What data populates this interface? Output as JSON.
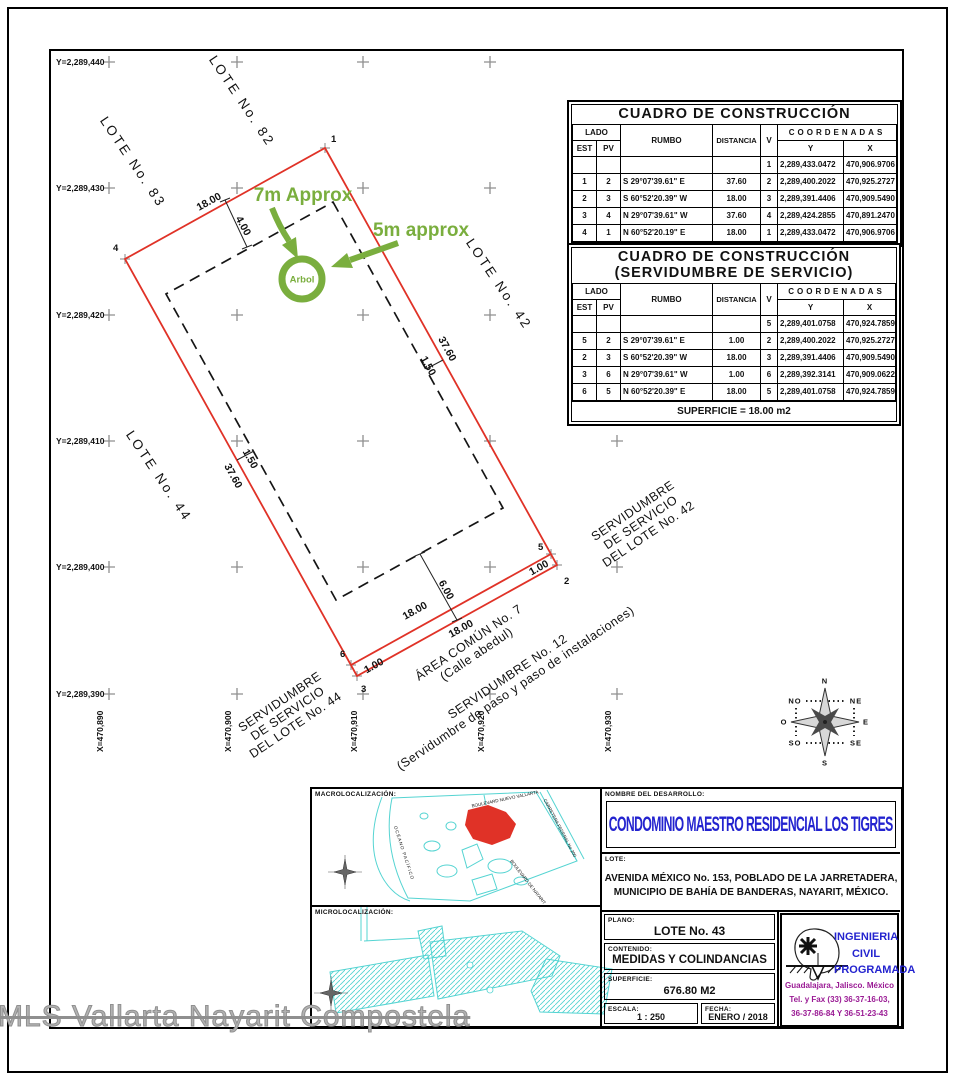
{
  "colors": {
    "boundary_red": "#e03227",
    "annotation_green": "#7aae3e",
    "title_blue": "#2323cf",
    "contact_purple": "#9a1a94",
    "map_cyan": "#55d4d2",
    "grid_gray": "#8f8f8f"
  },
  "plan": {
    "grid": {
      "y_labels": [
        "Y=2,289,440",
        "Y=2,289,430",
        "Y=2,289,420",
        "Y=2,289,410",
        "Y=2,289,400",
        "Y=2,289,390"
      ],
      "x_labels": [
        "X=470,890",
        "X=470,900",
        "X=470,910",
        "X=470,920",
        "X=470,930"
      ]
    },
    "vertices": [
      "1",
      "2",
      "3",
      "4",
      "5",
      "6"
    ],
    "neighbor_lots": {
      "l82": "LOTE No. 82",
      "l83": "LOTE No. 83",
      "l42": "LOTE No. 42",
      "l44": "LOTE No. 44"
    },
    "easements": {
      "serv42": [
        "SERVIDUMBRE",
        "DE SERVICIO",
        "DEL LOTE No. 42"
      ],
      "serv44": [
        "SERVIDUMBRE",
        "DE SERVICIO",
        "DEL LOTE No. 44"
      ],
      "area": [
        "ÁREA COMÚN No. 7",
        "(Calle abedul)"
      ],
      "serv12": [
        "SERVIDUMBRE No. 12",
        "(Servidumbre de paso y paso de instalaciones)"
      ]
    },
    "dims": {
      "top_18": "18.00",
      "off_4": "4.00",
      "right_37": "37.60",
      "right_1_5": "1.50",
      "left_37": "37.60",
      "left_1_5": "1.50",
      "bot_18a": "18.00",
      "bot_18b": "18.00",
      "off_6": "6.00",
      "strip_w": "1.00",
      "strip_e": "1.00"
    },
    "green": {
      "seven": "7m Approx",
      "five": "5m approx",
      "tree": "Arbol"
    },
    "compass": {
      "n": "N",
      "s": "S",
      "e": "E",
      "o": "O",
      "no": "NO",
      "ne": "NE",
      "so": "SO",
      "se": "SE"
    }
  },
  "table_headers": {
    "lado": "LADO",
    "est": "EST",
    "pv": "PV",
    "rumbo": "RUMBO",
    "distancia": "DISTANCIA",
    "v": "V",
    "coordenadas": "COORDENADAS",
    "y": "Y",
    "x": "X"
  },
  "tables": [
    {
      "title": "CUADRO DE CONSTRUCCIÓN",
      "rows": [
        [
          "",
          "",
          "",
          "",
          "1",
          "2,289,433.0472",
          "470,906.9706"
        ],
        [
          "1",
          "2",
          "S 29°07'39.61\" E",
          "37.60",
          "2",
          "2,289,400.2022",
          "470,925.2727"
        ],
        [
          "2",
          "3",
          "S 60°52'20.39\" W",
          "18.00",
          "3",
          "2,289,391.4406",
          "470,909.5490"
        ],
        [
          "3",
          "4",
          "N 29°07'39.61\" W",
          "37.60",
          "4",
          "2,289,424.2855",
          "470,891.2470"
        ],
        [
          "4",
          "1",
          "N 60°52'20.19\" E",
          "18.00",
          "1",
          "2,289,433.0472",
          "470,906.9706"
        ]
      ]
    },
    {
      "title": "CUADRO DE CONSTRUCCIÓN",
      "subtitle": "(SERVIDUMBRE DE SERVICIO)",
      "rows": [
        [
          "",
          "",
          "",
          "",
          "5",
          "2,289,401.0758",
          "470,924.7859"
        ],
        [
          "5",
          "2",
          "S 29°07'39.61\" E",
          "1.00",
          "2",
          "2,289,400.2022",
          "470,925.2727"
        ],
        [
          "2",
          "3",
          "S 60°52'20.39\" W",
          "18.00",
          "3",
          "2,289,391.4406",
          "470,909.5490"
        ],
        [
          "3",
          "6",
          "N 29°07'39.61\" W",
          "1.00",
          "6",
          "2,289,392.3141",
          "470,909.0622"
        ],
        [
          "6",
          "5",
          "N 60°52'20.39\" E",
          "18.00",
          "5",
          "2,289,401.0758",
          "470,924.7859"
        ]
      ],
      "footer": "SUPERFICIE = 18.00 m2"
    }
  ],
  "titleblock": {
    "macro_label": "MACROLOCALIZACIÓN:",
    "micro_label": "MICROLOCALIZACIÓN:",
    "macro_map_labels": {
      "blvd_nv": "BOULEVARD NUEVO VALLARTA",
      "carretera": "CARRETERA FEDERAL No 200",
      "oceano": "OCÉANO PACÍFICO",
      "blvd_nay": "BOULEVARD DE NAYARIT"
    },
    "nombre_label": "NOMBRE DEL DESARROLLO:",
    "nombre": "CONDOMINIO MAESTRO RESIDENCIAL LOS TIGRES",
    "lote_label": "LOTE:",
    "lote_line1": "AVENIDA MÉXICO No. 153, POBLADO DE LA JARRETADERA,",
    "lote_line2": "MUNICIPIO DE BAHÍA DE BANDERAS, NAYARIT, MÉXICO.",
    "plano_label": "PLANO:",
    "plano": "LOTE No. 43",
    "contenido_label": "CONTENIDO:",
    "contenido": "MEDIDAS Y COLINDANCIAS",
    "superficie_label": "SUPERFICIE:",
    "superficie": "676.80 M2",
    "escala_label": "ESCALA:",
    "escala": "1 : 250",
    "fecha_label": "FECHA:",
    "fecha": "ENERO / 2018",
    "company_line1": "INGENIERIA",
    "company_line2": "CIVIL",
    "company_line3": "PROGRAMADA",
    "company_city": "Guadalajara, Jalisco. México",
    "company_tel1": "Tel. y Fax (33) 36-37-16-03,",
    "company_tel2": "36-37-86-84 Y 36-51-23-43"
  },
  "watermark": "MLS Vallarta Nayarit Compostela"
}
